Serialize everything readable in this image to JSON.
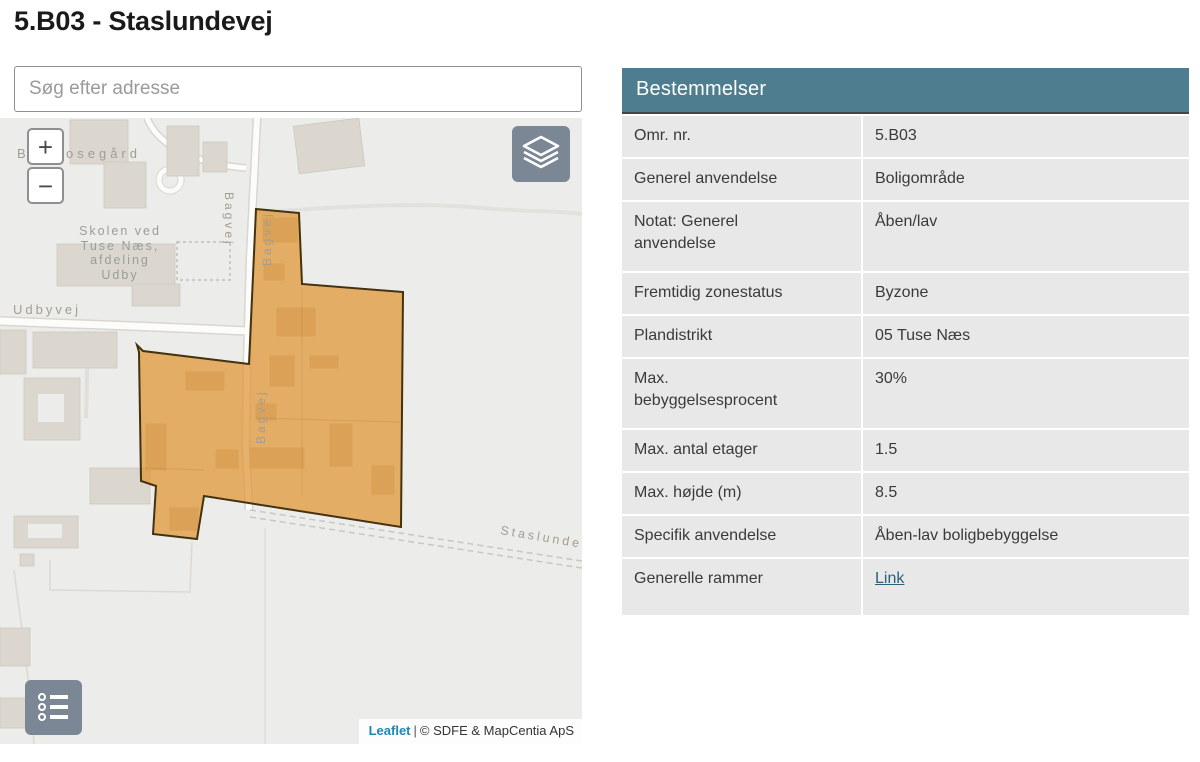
{
  "page": {
    "title": "5.B03 - Staslundevej"
  },
  "search": {
    "placeholder": "Søg efter adresse"
  },
  "map": {
    "controls": {
      "zoom_in": "+",
      "zoom_out": "−"
    },
    "labels": {
      "farm_fragment": "B",
      "farm_name": "osegård",
      "school": [
        "Skolen ved",
        "Tuse Næs,",
        "afdeling",
        "Udby"
      ],
      "road_udbyvej": "Udbyvej",
      "road_bagvej": "Bagvej",
      "road_staslundevej": "Staslunde"
    },
    "attribution": {
      "leaflet": "Leaflet",
      "divider": "|",
      "copyright": "© SDFE & MapCentia ApS"
    },
    "colors": {
      "zone_fill": "#e0922e",
      "zone_stroke": "#44320f",
      "control_gray": "#7b8794",
      "basemap_bg": "#ecedeb"
    }
  },
  "table": {
    "header": "Bestemmelser",
    "colors": {
      "header_bg": "#4d7d8e",
      "row_bg": "#e8e8e8",
      "link": "#2d5f79"
    },
    "rows": [
      {
        "label": "Omr. nr.",
        "value": "5.B03"
      },
      {
        "label": "Generel anvendelse",
        "value": "Boligområde"
      },
      {
        "label": "Notat: Generel anvendelse",
        "value": "Åben/lav"
      },
      {
        "label": "Fremtidig zonestatus",
        "value": "Byzone"
      },
      {
        "label": "Plandistrikt",
        "value": "05 Tuse Næs"
      },
      {
        "label": "Max. bebyggelsesprocent",
        "value": "30%"
      },
      {
        "label": "Max. antal etager",
        "value": "1.5"
      },
      {
        "label": "Max. højde (m)",
        "value": "8.5"
      },
      {
        "label": "Specifik anvendelse",
        "value": "Åben-lav boligbebyggelse"
      },
      {
        "label": "Generelle rammer",
        "value": "Link"
      }
    ]
  }
}
